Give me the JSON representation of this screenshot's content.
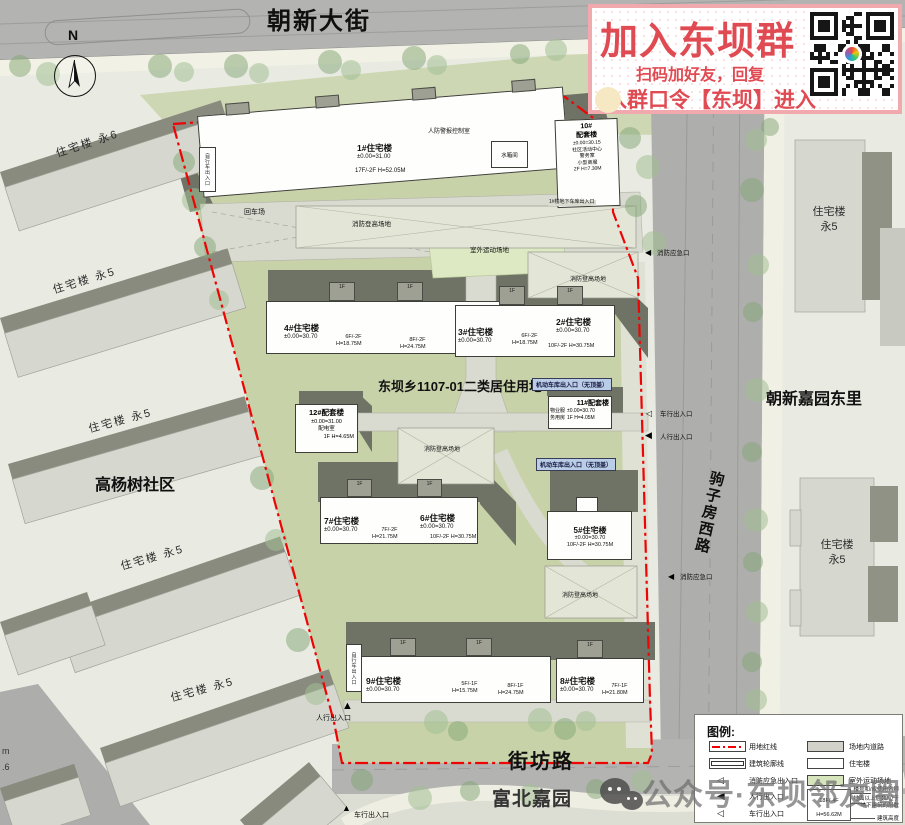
{
  "roads": {
    "top": "朝新大街",
    "right": "驹子房西路",
    "bottom": "街坊路"
  },
  "districts": {
    "left": "高杨树社区",
    "right_top": "朝新嘉园东里",
    "bottom": "富北嘉园"
  },
  "site": {
    "title": "东坝乡1107-01二类居住用地"
  },
  "context": {
    "yong6": "住宅楼 永6",
    "yong5": "住宅楼 永5",
    "zhuzhailou": "住宅楼",
    "yong5s": "永5"
  },
  "b1": {
    "name": "1#住宅楼",
    "elev": "±0.00=31.00",
    "spec": "17F/-2F H=52.05M"
  },
  "b2": {
    "name": "2#住宅楼",
    "elev": "±0.00=30.70",
    "spec": "10F/-2F H=30.75M"
  },
  "b3": {
    "name": "3#住宅楼",
    "elev": "±0.00=30.70",
    "s1": "6F/-2F",
    "s2": "H=18.75M"
  },
  "b4": {
    "name": "4#住宅楼",
    "elev": "±0.00=30.70",
    "sA1": "6F/-2F",
    "sA2": "H=18.75M",
    "sB1": "8F/-2F",
    "sB2": "H=24.75M"
  },
  "b5": {
    "name": "5#住宅楼",
    "elev": "±0.00=30.70",
    "spec": "10F/-2F H=30.75M"
  },
  "b6": {
    "name": "6#住宅楼",
    "elev": "±0.00=30.70",
    "spec": "10F/-2F H=30.75M"
  },
  "b7": {
    "name": "7#住宅楼",
    "elev": "±0.00=30.70",
    "s1": "7F/-2F",
    "s2": "H=21.75M"
  },
  "b8": {
    "name": "8#住宅楼",
    "elev": "±0.00=30.70",
    "s1": "7F/-1F",
    "s2": "H=21.80M"
  },
  "b9": {
    "name": "9#住宅楼",
    "elev": "±0.00=30.70",
    "sA1": "5F/-1F",
    "sA2": "H=15.75M",
    "sB1": "8F/-1F",
    "sB2": "H=24.75M"
  },
  "b10": {
    "n1": "10#",
    "n2": "配套楼",
    "elev": "±0.00=30.15",
    "u1": "社区活动中心",
    "u2": "警务室",
    "u3": "小型商服",
    "spec": "2F H=7.30M"
  },
  "b11": {
    "name": "11#配套楼",
    "u1": "物业服",
    "u2": "务用房",
    "elev": "±0.00=30.70",
    "spec": "1F H=4.05M"
  },
  "b12": {
    "name": "12#配套楼",
    "elev": "±0.00=31.00",
    "use": "配电室",
    "spec": "1F H=4.65M"
  },
  "common": {
    "f1": "1F",
    "fire_ladder": "消防登高场地",
    "sports": "室外运动场地",
    "turn": "回车场",
    "tank": "水箱间",
    "civil": "人防警报控制室",
    "garage": "机动车库出入口（无顶盖）",
    "b1garage": "1#楼地下车库出入口",
    "bike": "自行车出入口"
  },
  "ent": {
    "ped": "人行出入口",
    "veh": "车行出入口",
    "fire": "消防应急口"
  },
  "legend": {
    "title": "图例:",
    "l1": "用地红线",
    "l2": "建筑轮廓线",
    "l3": "消防应急出入口",
    "l4": "人行出入口",
    "l5": "车行出入口",
    "r1": "场地内道路",
    "r2": "住宅楼",
    "r3": "室外运动场地",
    "s_floors": "18F/-4F",
    "s_height": "H=56.62M",
    "a1": "楼号和/或使用名称",
    "a2a": "地面以上层数/位于",
    "a2b": "地下建筑的层数",
    "a3": "建筑高度"
  },
  "ad": {
    "title": "加入东坝群",
    "line1": "扫码加好友，回复",
    "line2": "入群口令【东坝】进入"
  },
  "wm": {
    "text": "公众号·东坝邻友圈"
  },
  "compass": {
    "n": "N"
  },
  "frag": {
    "a": "m",
    "b": ".6"
  }
}
